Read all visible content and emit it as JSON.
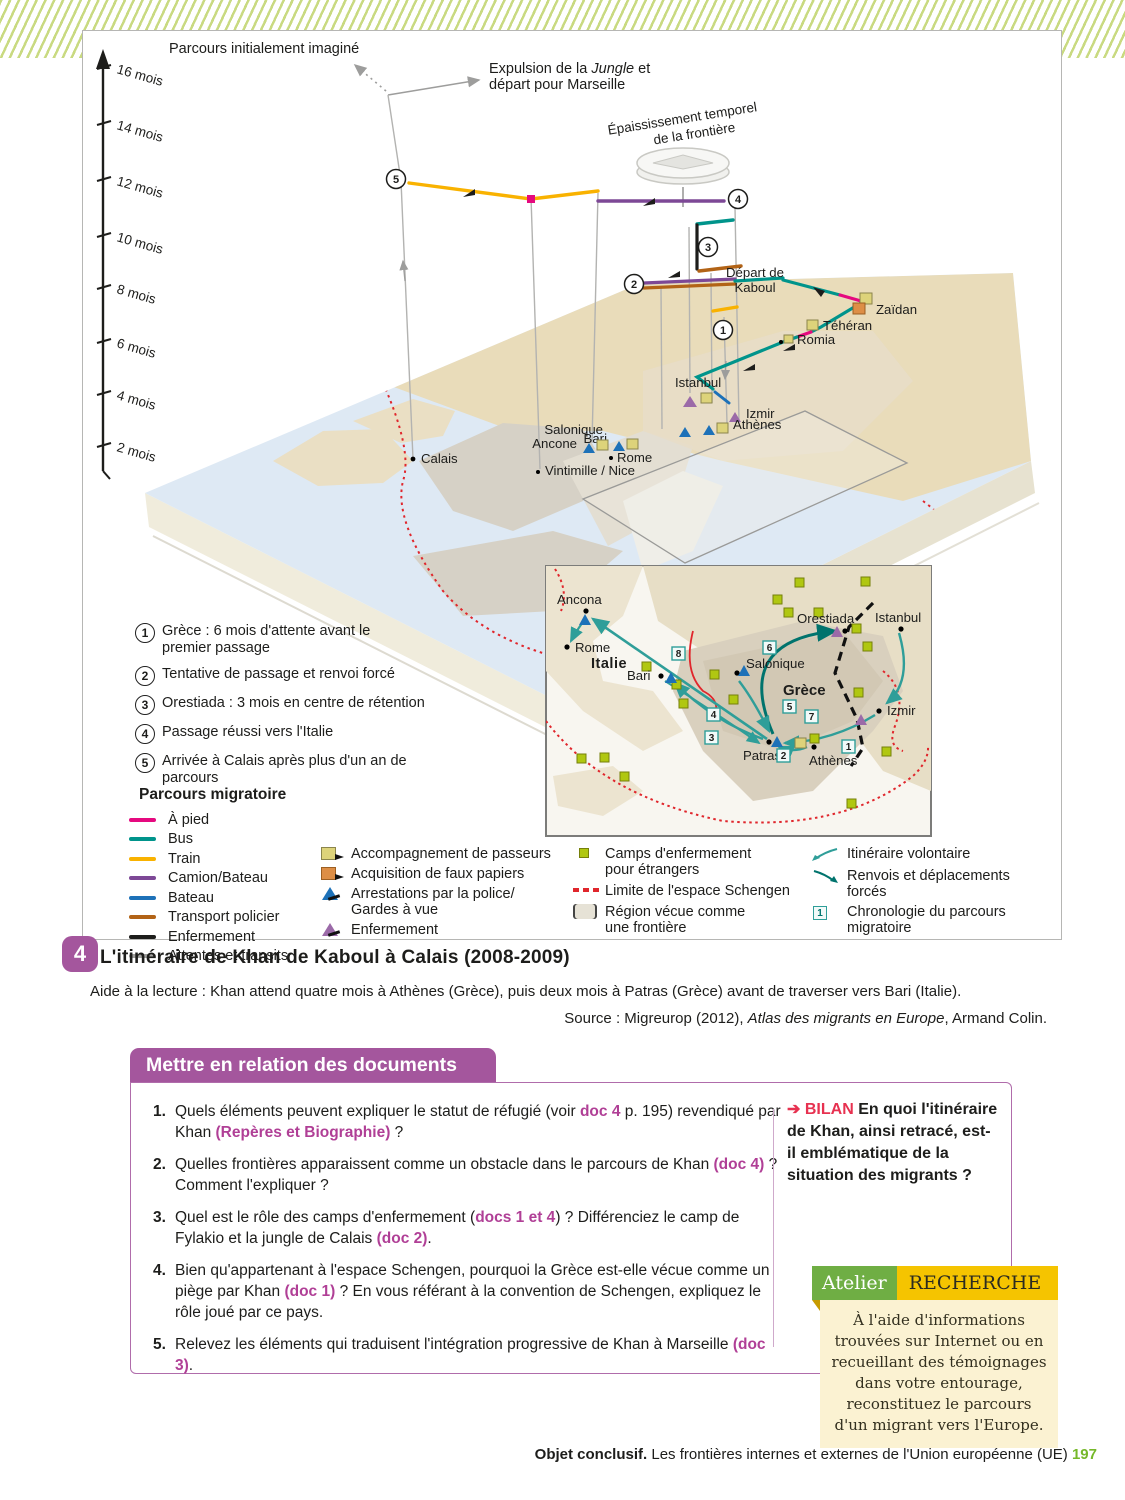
{
  "colors": {
    "stripe": "#c9da81",
    "purple": "#a4569d",
    "doc": "#b03f96",
    "bilan": "#e73150",
    "at_green": "#6fae44",
    "at_yellow": "#f5c400",
    "at_cream": "#fbf2d2",
    "page_green": "#76b82a",
    "pied": "#e5097f",
    "bus": "#00948b",
    "train": "#f9b200",
    "camion": "#7d4896",
    "bateau": "#1d71b8",
    "policier": "#b26316",
    "enfer": "#1d1d1b",
    "attente": "#a0a09e",
    "khaki": "#ddd37a",
    "orange": "#dd8e46",
    "tri_blue": "#1d71b8",
    "tri_purple": "#9b6aa8",
    "camp": "#b0c711",
    "schengen": "#e0262c",
    "teal": "#2f9e99",
    "tealdark": "#00736d",
    "sea": "#dee9f4",
    "land_gray": "#d6d1c6",
    "land_beige": "#eadfc4",
    "land_me": "#e9dcba",
    "slab_side": "#f0ecdc"
  },
  "f": {
    "axis": {
      "labels": [
        "16 mois",
        "14 mois",
        "12 mois",
        "10 mois",
        "8 mois",
        "6 mois",
        "4 mois",
        "2 mois"
      ]
    },
    "ann": {
      "initial": "Parcours initialement imaginé",
      "exp1": "Expulsion de la ",
      "expIt": "Jungle",
      "exp2": " et",
      "exp3": "départ pour Marseille",
      "th1": "Épaississement temporel",
      "th2": "de la frontière"
    },
    "steps": [
      "1",
      "2",
      "3",
      "4",
      "5"
    ],
    "cities": {
      "kaboul1": "Départ de",
      "kaboul2": "Kaboul",
      "zaidan": "Zaïdan",
      "teheran": "Téhéran",
      "romia": "Romia",
      "istanbul": "Istanbul",
      "izmir": "Izmir",
      "athenes": "Athènes",
      "salonique": "Salonique",
      "bari": "Bari",
      "rome": "Rome",
      "ancone": "Ancone",
      "vintimille": "Vintimille / Nice",
      "calais": "Calais"
    },
    "notes": [
      {
        "n": "1",
        "t": "Grèce : 6 mois d'attente avant le premier passage"
      },
      {
        "n": "2",
        "t": "Tentative de passage et renvoi forcé"
      },
      {
        "n": "3",
        "t": "Orestiada : 3 mois en centre de rétention"
      },
      {
        "n": "4",
        "t": "Passage réussi vers l'Italie"
      },
      {
        "n": "5",
        "t": "Arrivée à Calais après plus d'un an de parcours"
      }
    ],
    "legend": {
      "title": "Parcours migratoire",
      "lines": [
        {
          "label": "À pied"
        },
        {
          "label": "Bus"
        },
        {
          "label": "Train"
        },
        {
          "label": "Camion/Bateau"
        },
        {
          "label": "Bateau"
        },
        {
          "label": "Transport policier"
        },
        {
          "label": "Enfermement"
        },
        {
          "label": "Attentes et transits"
        }
      ],
      "markers": [
        {
          "label": "Accompagnement de passeurs"
        },
        {
          "label": "Acquisition de faux papiers"
        },
        {
          "label": "Arrestations par la police/ Gardes à vue"
        },
        {
          "label": "Enfermement"
        }
      ],
      "areas": [
        {
          "label": "Camps d'enfermement pour étrangers"
        },
        {
          "label": "Limite de l'espace Schengen"
        },
        {
          "label": "Région vécue comme une frontière"
        }
      ],
      "arrows": [
        {
          "label": "Itinéraire volontaire"
        },
        {
          "label": "Renvois et déplacements forcés"
        },
        {
          "label": "Chronologie du parcours migratoire"
        }
      ],
      "chrono_symbol": "1"
    },
    "inset": {
      "cities": {
        "ancona": "Ancona",
        "rome": "Rome",
        "italie": "Italie",
        "bari": "Bari",
        "orestiada": "Orestiada",
        "istanbul": "Istanbul",
        "salonique": "Salonique",
        "grece": "Grèce",
        "izmir": "Izmir",
        "patras": "Patras",
        "athenes": "Athènes"
      },
      "chrono": [
        "1",
        "2",
        "3",
        "4",
        "5",
        "6",
        "7",
        "8"
      ]
    }
  },
  "caption": {
    "num": "4",
    "title": "L'itinéraire de Khan de Kaboul à Calais (2008-2009)",
    "aide_bold": "Aide à la lecture :",
    "aide_rest": " Khan attend quatre mois à Athènes (Grèce), puis deux mois à Patras (Grèce) avant de traverser vers Bari (Italie).",
    "source1": "Source : Migreurop (2012), ",
    "source2": "Atlas des migrants en Europe",
    "source3": ", Armand Colin."
  },
  "q": {
    "header": "Mettre en relation des documents",
    "items": [
      {
        "n": "1.",
        "parts": [
          {
            "t": "Quels éléments peuvent expliquer le statut de réfugié (voir "
          },
          {
            "t": "doc 4",
            "s": "doc"
          },
          {
            "t": " p. 195) revendiqué par Khan "
          },
          {
            "t": "(Repères et Biographie)",
            "s": "doc"
          },
          {
            "t": " ?"
          }
        ]
      },
      {
        "n": "2.",
        "parts": [
          {
            "t": "Quelles frontières apparaissent comme un obstacle dans le parcours de Khan "
          },
          {
            "t": "(doc 4)",
            "s": "doc"
          },
          {
            "t": " ? Comment l'expliquer ?"
          }
        ]
      },
      {
        "n": "3.",
        "parts": [
          {
            "t": "Quel est le rôle des camps d'enfermement ("
          },
          {
            "t": "docs 1 et 4",
            "s": "doc"
          },
          {
            "t": ") ? Différenciez le camp de Fylakio et la jungle de Calais "
          },
          {
            "t": "(doc 2)",
            "s": "doc"
          },
          {
            "t": "."
          }
        ]
      },
      {
        "n": "4.",
        "parts": [
          {
            "t": "Bien qu'appartenant à l'espace Schengen, pourquoi la Grèce est-elle vécue comme un piège par Khan "
          },
          {
            "t": "(doc 1)",
            "s": "doc"
          },
          {
            "t": " ? En vous référant à la convention de Schengen, expliquez le rôle joué par ce pays."
          }
        ]
      },
      {
        "n": "5.",
        "parts": [
          {
            "t": "Relevez les éléments qui traduisent l'intégration progressive de Khan à Marseille "
          },
          {
            "t": "(doc 3)",
            "s": "doc"
          },
          {
            "t": "."
          }
        ]
      }
    ]
  },
  "bilan": {
    "arrow": "➔ ",
    "label": "BILAN",
    "rest": " En quoi l'itinéraire de Khan, ainsi retracé, est-il emblématique de la situation des migrants ?"
  },
  "atelier": {
    "tab": "Atelier",
    "header": "RECHERCHE",
    "body": "À l'aide d'informations trouvées sur Internet ou en recueillant des témoignages dans votre entourage, reconstituez le parcours d'un migrant vers l'Europe."
  },
  "footer": {
    "b": "Objet conclusif.",
    "t": " Les frontières internes et externes de l'Union européenne (UE) ",
    "page": "197"
  }
}
